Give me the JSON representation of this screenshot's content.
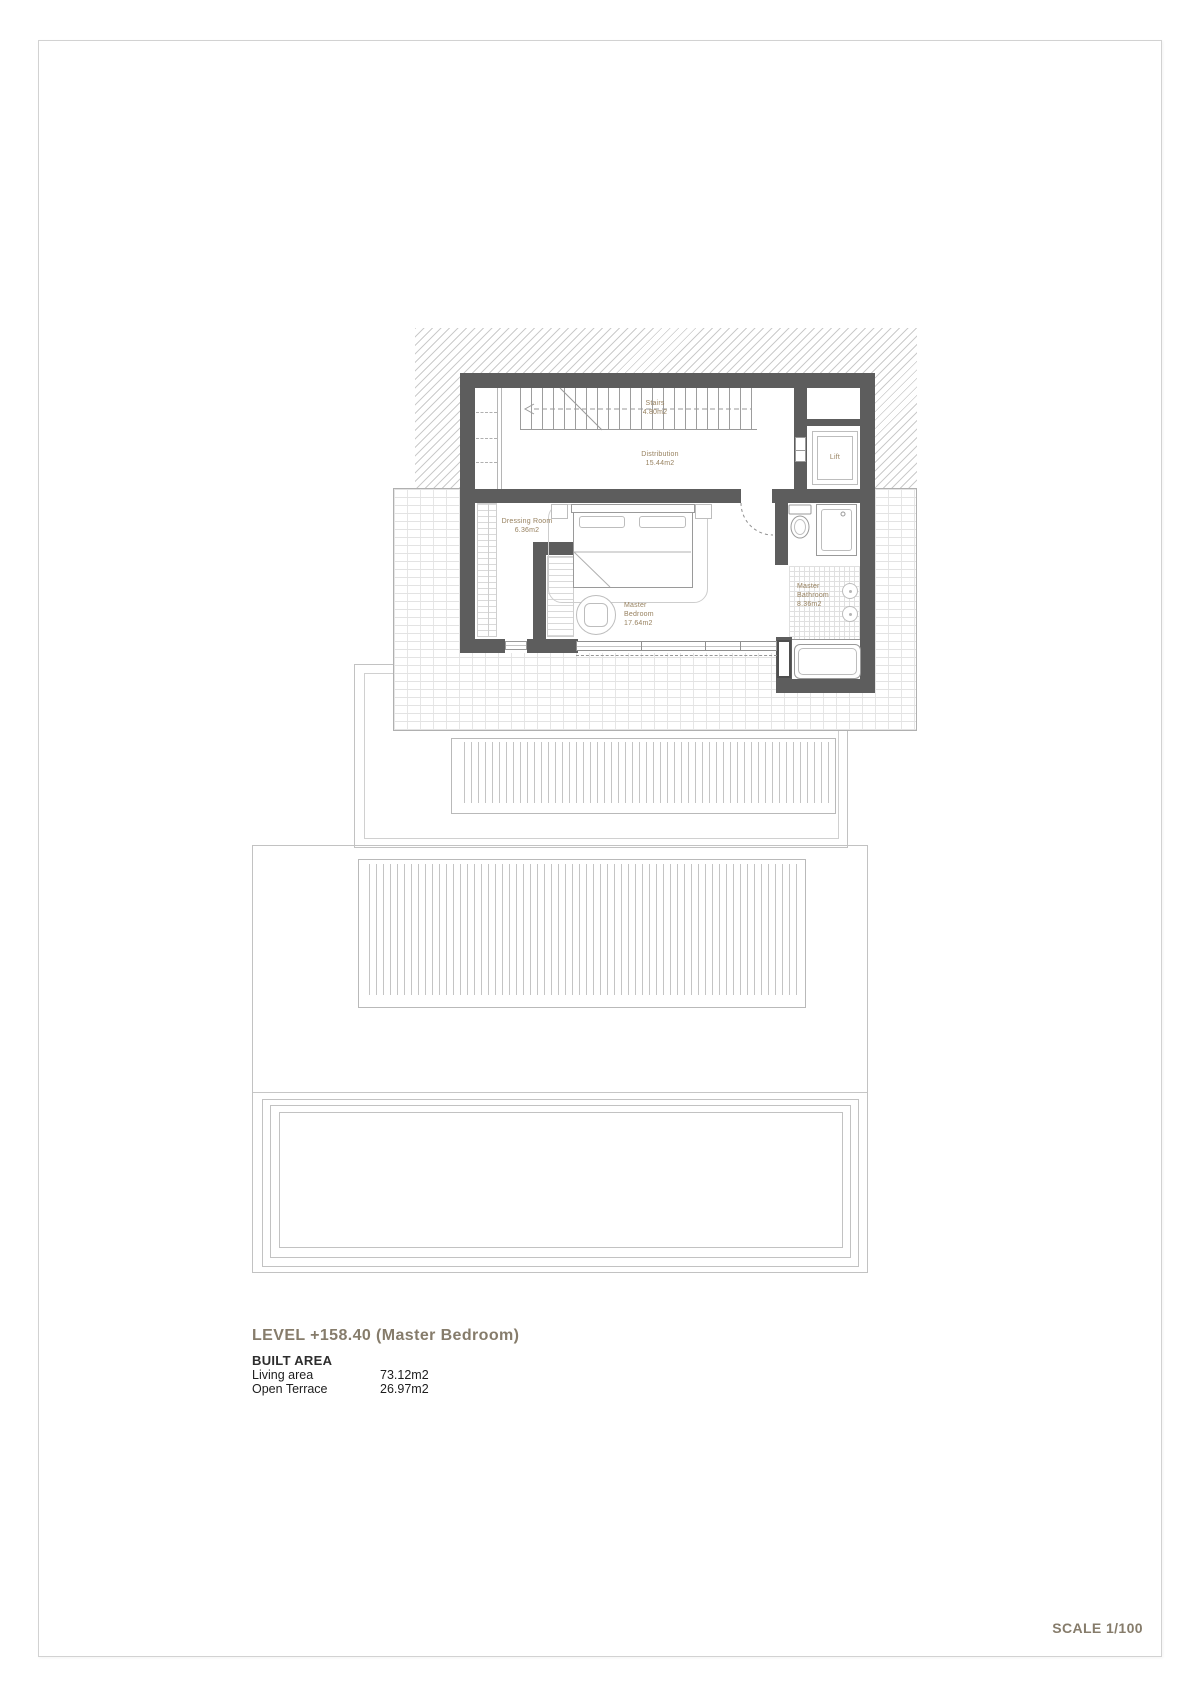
{
  "plan_labels": {
    "stairs": {
      "l1": "Stairs",
      "l2": "4.80m2"
    },
    "distribution": {
      "l1": "Distribution",
      "l2": "15.44m2"
    },
    "dressing_room": {
      "l1": "Dressing Room",
      "l2": "6.36m2"
    },
    "master_bedroom": {
      "l1": "Master",
      "l2": "Bedroom",
      "l3": "17.64m2"
    },
    "master_bathroom": {
      "l1": "Master",
      "l2": "Bathroom",
      "l3": "8.36m2"
    },
    "lift": {
      "l1": "Lift"
    }
  },
  "title_block": {
    "level_title": "LEVEL +158.40 (Master Bedroom)",
    "built_area_heading": "BUILT AREA",
    "rows": [
      {
        "label": "Living area",
        "value": "73.12m2"
      },
      {
        "label": "Open Terrace",
        "value": "26.97m2"
      }
    ]
  },
  "scale_note": "SCALE 1/100",
  "colors": {
    "wall": "#5d5d5d",
    "room_label": "#97815f",
    "title_text": "#867c6b",
    "table_text": "#1d1d1d",
    "hatch_line": "#cbcbcb",
    "terrace_outline": "#b5b5b5"
  }
}
